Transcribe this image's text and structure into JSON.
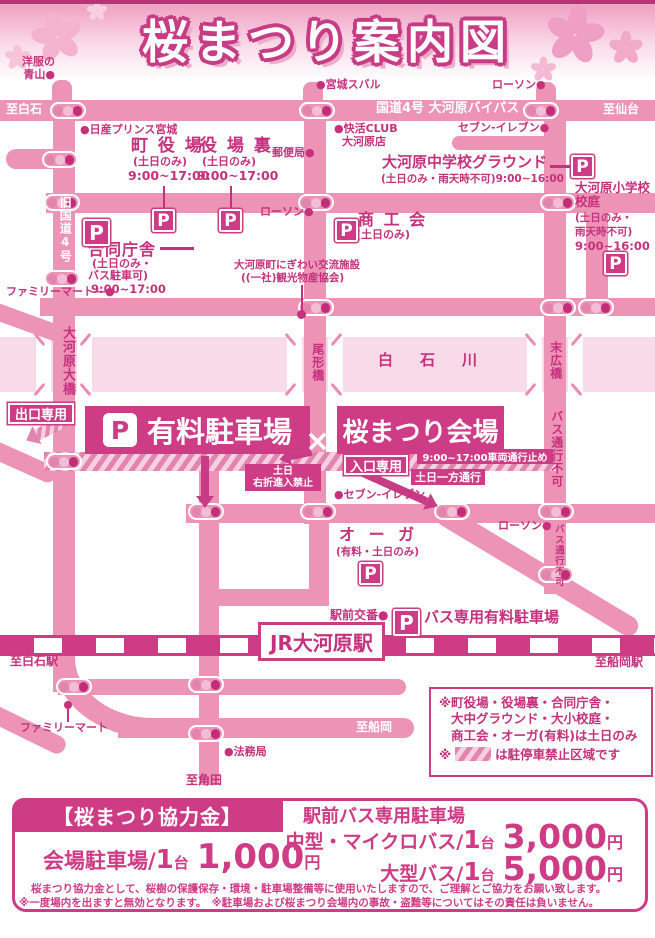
{
  "title": "桜まつり案内図",
  "colors": {
    "accent": "#cf3c86",
    "road_pink": "#ec93b6",
    "river_pink": "#f8dae8",
    "text_magenta": "#c5317c"
  },
  "icons": {
    "p": "P"
  },
  "top_road": {
    "left": "至白石",
    "name": "国道4号 大河原バイパス",
    "right": "至仙台"
  },
  "roads": {
    "kyu4": "旧国道4号"
  },
  "river": {
    "name": "白　石　川"
  },
  "bridges": {
    "ogawara": "大河原大橋",
    "ogata": "尾形橋",
    "suehiro": "末広橋",
    "bus_no1": "バス通行不可",
    "bus_no2": "バス通行不可"
  },
  "pois": {
    "aoyama1": "洋服の",
    "aoyama2": "青山●",
    "subaru": "●宮城スバル",
    "lawson_top": "ローソン●",
    "nissan": "●日産プリンス宮城",
    "post": "郵便局●",
    "kaikatsu1": "●快活CLUB",
    "kaikatsu2": "大河原店",
    "seven_top": "セブン-イレブン●",
    "lawson_mid": "ローソン●",
    "seven_low": "●セブン-イレブン",
    "lawson_low": "ローソン●",
    "koban": "駅前交番●",
    "homu": "●法務局",
    "famima_top": "ファミリーマート―●",
    "famima_low": "ファミリーマート"
  },
  "parkings": {
    "machiyakuba": {
      "name": "町 役 場",
      "days": "(土日のみ)",
      "hours": "9:00~17:00"
    },
    "yakubaura": {
      "name": "役 場 裏",
      "days": "(土日のみ)",
      "hours": "9:00~17:00"
    },
    "godochosha": {
      "name": "合同庁舎",
      "days": "(土日のみ・",
      "days2": "バス駐車可)",
      "hours": "9:00~17:00"
    },
    "chugakko": {
      "name": "大河原中学校グラウンド",
      "note": "(土日のみ・雨天時不可)9:00~16:00"
    },
    "shogakko": {
      "l1": "大河原小学校",
      "l2": "校庭",
      "l3": "(土日のみ・",
      "l4": "雨天時不可)",
      "l5": "9:00~16:00"
    },
    "shokokai": {
      "name": "商 工 会",
      "days": "(土日のみ)"
    },
    "oga": {
      "name": "オ ー ガ",
      "days": "(有料・土日のみ)"
    },
    "bus": {
      "name": "バス専用有料駐車場"
    },
    "nigiwai": {
      "l1": "大河原町にぎわい交流施設",
      "l2": "((一社)観光物産協会)"
    }
  },
  "venue": {
    "parking": "有料駐車場",
    "site": "桜まつり会場",
    "x": "×"
  },
  "traffic": {
    "exit": "出口専用",
    "entrance": "入口専用",
    "closed": "9:00~17:00車両通行止め",
    "oneway": "土日一方通行",
    "noright1": "土日",
    "noright2": "右折進入禁止"
  },
  "stations": {
    "jr": "JR大河原駅",
    "shiroishi": "至白石駅",
    "funaoka_st": "至船岡駅",
    "funaoka": "至船岡",
    "kakuda": "至角田"
  },
  "notes": {
    "l1": "※町役場・役場裏・合同庁舎・",
    "l2": "大中グラウンド・大小校庭・",
    "l3": "商工会・オーガ(有料)は土日のみ",
    "l4a": "※",
    "l4b": "は駐停車禁止区域です"
  },
  "fees": {
    "header": "【桜まつり協力金】",
    "bus_title": "駅前バス専用駐車場",
    "venue_label": "会場駐車場",
    "slash": "/",
    "per_num": "1",
    "per_unit": "台",
    "venue_amount": "1,000",
    "yen": "円",
    "mid_label": "中型・マイクロバス",
    "mid_amount": "3,000",
    "large_label": "大型バス",
    "large_amount": "5,000",
    "note1": "桜まつり協力金として、桜樹の保護保存・環境・駐車場整備等に使用いたしますので、ご理解とご協力をお願い致します。",
    "note2": "※一度場内を出ますと無効となります。　※駐車場および桜まつり会場内の事故・盗難等についてはその責任は負いません。"
  }
}
